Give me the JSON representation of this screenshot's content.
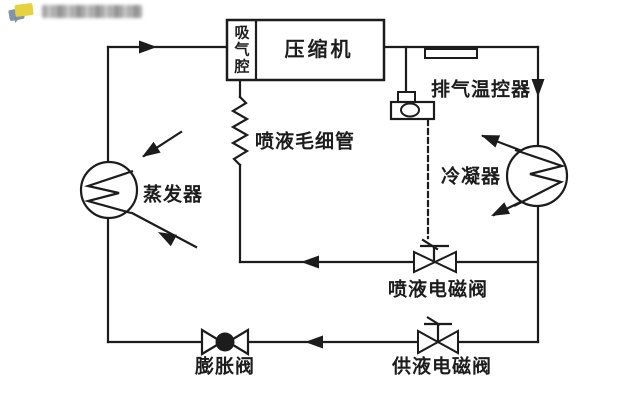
{
  "header": {
    "sticker_icon": "chat-sticker-icon",
    "watermark_blurred": true
  },
  "diagram": {
    "type": "refrigeration-cycle-schematic",
    "colors": {
      "line": "#1c1c1c",
      "background": "#ffffff",
      "watermark_yellow": "#e6d23e",
      "watermark_blue": "#8194a8"
    },
    "components": {
      "compressor": {
        "label": "压缩机"
      },
      "suction_chamber": {
        "label": "吸气腔"
      },
      "discharge_thermostat": {
        "label": "排气温控器"
      },
      "injection_capillary": {
        "label": "喷液毛细管"
      },
      "condenser": {
        "label": "冷凝器"
      },
      "evaporator": {
        "label": "蒸发器"
      },
      "injection_solenoid_valve": {
        "label": "喷液电磁阀"
      },
      "expansion_valve": {
        "label": "膨胀阀"
      },
      "supply_solenoid_valve": {
        "label": "供液电磁阀"
      }
    }
  }
}
